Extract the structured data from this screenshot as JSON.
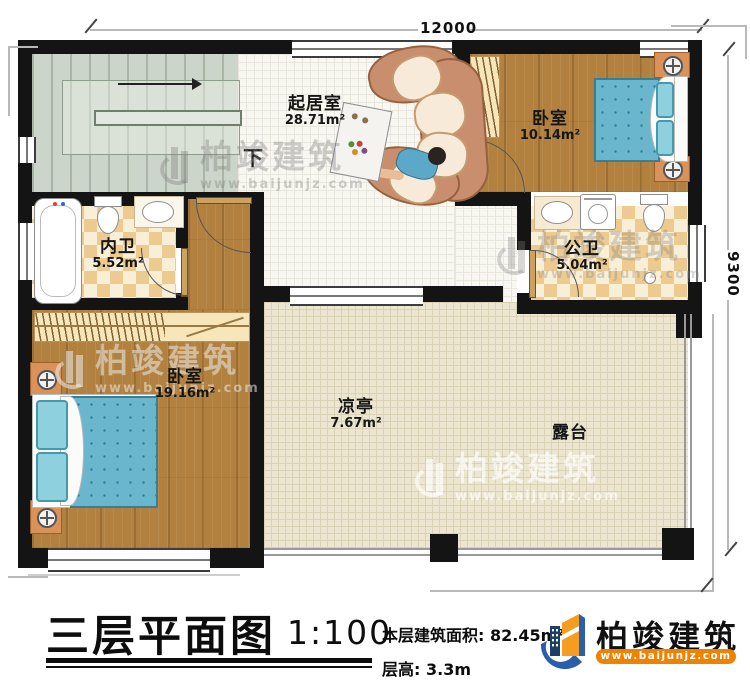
{
  "title_block": {
    "title": "三层平面图",
    "scale": "1:100",
    "area_label": "本层建筑面积:",
    "area_value": "82.45m²",
    "height_label": "层高:",
    "height_value": "3.3m"
  },
  "brand": {
    "name": "柏竣建筑",
    "website": "www.baijunjz.com"
  },
  "dimensions": {
    "width": "12000",
    "depth": "9300"
  },
  "stairs": {
    "direction_label": "下"
  },
  "rooms": [
    {
      "name": "起居室",
      "area": "28.71m²"
    },
    {
      "name": "卧室",
      "area": "10.14m²"
    },
    {
      "name": "内卫",
      "area": "5.52m²"
    },
    {
      "name": "公卫",
      "area": "5.04m²"
    },
    {
      "name": "卧室",
      "area": "19.16m²"
    },
    {
      "name": "凉亭",
      "area": "7.67m²"
    },
    {
      "name": "露台",
      "area": ""
    }
  ],
  "watermark": {
    "name": "柏竣建筑",
    "website": "www.baijunjz.com"
  },
  "colors": {
    "wall": "#141414",
    "wood_floor": "#b2813f",
    "bath_tile": "#ecca90",
    "terrace_tile": "#ece6d0",
    "stair": "#ccd5c9",
    "bed_blue": "#6ab7cd",
    "brand_blue": "#2b5daa",
    "brand_orange": "#f08300"
  }
}
